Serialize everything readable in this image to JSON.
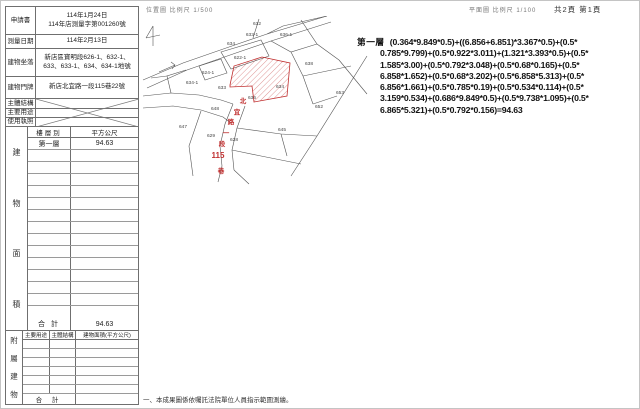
{
  "page": {
    "scale_note_left": "位置圖 比例尺 1/500",
    "scale_note_right": "平面圖 比例尺 1/100",
    "page_indicator": "共2頁 第1頁",
    "footnote": "一、本成果圖係依囑託法院單位人員指示範圍測繪。"
  },
  "info_table": {
    "rows": [
      {
        "label": "申請書",
        "value": "114年1月24日",
        "value2": "114年店測量字第001260號"
      },
      {
        "label": "測量日期",
        "value": "114年2月13日"
      },
      {
        "label": "建物坐落",
        "value": "新店區寶明段626-1、632-1、633、633-1、634、634-1地號"
      },
      {
        "label": "建物門牌",
        "value": "新店北宜路一段115巷22號"
      },
      {
        "label": "主體結構",
        "value": ""
      },
      {
        "label": "主要用途",
        "value": ""
      },
      {
        "label": "使用執照",
        "value": ""
      }
    ]
  },
  "area_table": {
    "section_label": "建物面積",
    "col_floor": "樓層別",
    "col_area": "平方公尺",
    "first_row": {
      "floor": "第一層",
      "area": "94.63"
    },
    "empty_row_count": 14,
    "total_label": "合 計",
    "total_value": "94.63"
  },
  "annex_table": {
    "section_label": "附屬建物",
    "headers": [
      "主要用途",
      "主體結構",
      "建物面積(平方公尺)"
    ],
    "empty_row_count": 6,
    "total_label": "合 計"
  },
  "calculation": {
    "floor_label": "第一層",
    "lines": [
      "(0.364*9.849*0.5)+((6.856+6.851)*3.367*0.5)+(0.5*",
      "0.785*9.799)+(0.5*0.922*3.011)+(1.321*3.393*0.5)+(0.5*",
      "1.585*3.00)+(0.5*0.792*3.048)+(0.5*0.68*0.165)+(0.5*",
      "6.858*1.652)+(0.5*0.68*3.202)+(0.5*6.858*5.313)+(0.5*",
      "6.856*1.661)+(0.5*0.785*0.19)+(0.5*0.534*0.114)+(0.5*",
      "3.159*0.534)+(0.686*9.849*0.5)+(0.5*9.738*1.095)+(0.5*",
      "6.865*5.321)+(0.5*0.792*0.156)=94.63"
    ]
  },
  "map": {
    "red_color": "#c03030",
    "line_color": "#555555",
    "parcel_labels": [
      {
        "text": "632",
        "x": 116,
        "y": 9
      },
      {
        "text": "636-1",
        "x": 145,
        "y": 20
      },
      {
        "text": "633-1",
        "x": 111,
        "y": 20
      },
      {
        "text": "634",
        "x": 90,
        "y": 29
      },
      {
        "text": "622-1",
        "x": 99,
        "y": 43
      },
      {
        "text": "638",
        "x": 168,
        "y": 49
      },
      {
        "text": "624-1",
        "x": 67,
        "y": 58
      },
      {
        "text": "634-1",
        "x": 51,
        "y": 68
      },
      {
        "text": "633",
        "x": 81,
        "y": 73
      },
      {
        "text": "634",
        "x": 139,
        "y": 72
      },
      {
        "text": "653",
        "x": 199,
        "y": 78
      },
      {
        "text": "636",
        "x": 111,
        "y": 83
      },
      {
        "text": "652",
        "x": 178,
        "y": 92
      },
      {
        "text": "648",
        "x": 74,
        "y": 94
      },
      {
        "text": "647",
        "x": 42,
        "y": 112
      },
      {
        "text": "645",
        "x": 141,
        "y": 115
      },
      {
        "text": "629",
        "x": 70,
        "y": 121
      },
      {
        "text": "628",
        "x": 93,
        "y": 125
      }
    ],
    "street_label": [
      {
        "text": "北",
        "x": 102,
        "y": 87
      },
      {
        "text": "宜",
        "x": 96,
        "y": 98
      },
      {
        "text": "路",
        "x": 90,
        "y": 108
      },
      {
        "text": "一",
        "x": 85,
        "y": 119
      },
      {
        "text": "段",
        "x": 81,
        "y": 130
      },
      {
        "text": "115",
        "x": 77,
        "y": 142,
        "big": true
      },
      {
        "text": "巷",
        "x": 80,
        "y": 157
      }
    ]
  }
}
